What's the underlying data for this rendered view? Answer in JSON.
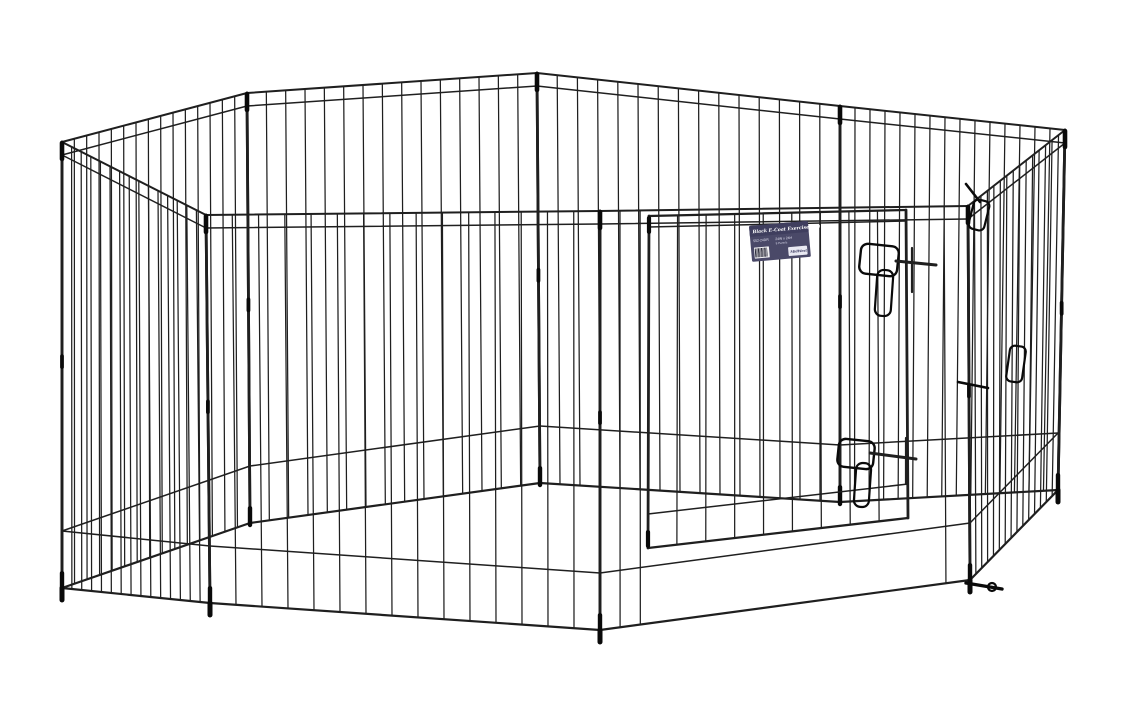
{
  "page": {
    "background_color": "#ffffff"
  },
  "label_tag": {
    "title": "Black E-Coat Exercise Pen",
    "model": "552-24DR",
    "size": "24W x 24H",
    "panels_note": "8 Panels",
    "logo": "MidWest",
    "bg_color": "#4a4968",
    "band_color": "#3f3e5e",
    "barcode_bg": "#f4f4f6",
    "barcode_lines": 12
  },
  "figure": {
    "wire_color": "#1f1f1f",
    "wire_dark": "#0a0a0a",
    "top_corners": [
      [
        62,
        142
      ],
      [
        247,
        93
      ],
      [
        537,
        73
      ],
      [
        840,
        106
      ],
      [
        1065,
        130
      ],
      [
        968,
        206
      ],
      [
        600,
        211
      ],
      [
        206,
        215
      ]
    ],
    "bottom_corners": [
      [
        62,
        588
      ],
      [
        250,
        523
      ],
      [
        540,
        483
      ],
      [
        840,
        502
      ],
      [
        1058,
        490
      ],
      [
        970,
        580
      ],
      [
        600,
        630
      ],
      [
        210,
        603
      ]
    ],
    "panel_draw_order": [
      [
        1,
        2
      ],
      [
        2,
        3
      ],
      [
        0,
        1
      ],
      [
        3,
        4
      ],
      [
        4,
        5
      ],
      [
        7,
        0
      ],
      [
        6,
        7
      ],
      [
        5,
        6
      ]
    ],
    "door_panel": [
      5,
      6
    ],
    "bars_per_panel": 14,
    "top_rail_offset": 13,
    "bottom_rail_offset": 57,
    "feet_corners": [
      0,
      4,
      5,
      6,
      7
    ],
    "door": {
      "tl": [
        649,
        216
      ],
      "tr": [
        906,
        210
      ],
      "br": [
        908,
        518
      ],
      "bl": [
        648,
        548
      ],
      "bars": 8,
      "top_rail_offset": 11,
      "bottom_rail_offset": 34,
      "side_bar_ts": [
        0.065,
        0.891,
        0.9457
      ]
    },
    "latches": [
      {
        "loop": [
          860,
          245,
          38,
          30
        ],
        "tongue": [
          876,
          270,
          16,
          46
        ],
        "bolt": [
          896,
          261,
          936,
          265
        ],
        "catch": [
          912,
          248,
          912,
          292
        ]
      },
      {
        "loop": [
          838,
          440,
          36,
          28
        ],
        "tongue": [
          855,
          463,
          15,
          44
        ],
        "bolt": [
          870,
          453,
          916,
          459
        ],
        "catch": [
          906,
          438,
          906,
          484
        ]
      }
    ],
    "clips": [
      {
        "rod": [
          966,
          184,
          980,
          202
        ],
        "paddle": [
          971,
          200,
          16,
          30
        ],
        "rot": 14
      },
      {
        "rod": [
          958,
          382,
          988,
          388
        ],
        "paddle": [
          1008,
          346,
          16,
          36
        ],
        "rot": 8
      }
    ],
    "anchor": {
      "rod": [
        966,
        583,
        1002,
        589
      ],
      "head": [
        992,
        587,
        4
      ]
    }
  }
}
